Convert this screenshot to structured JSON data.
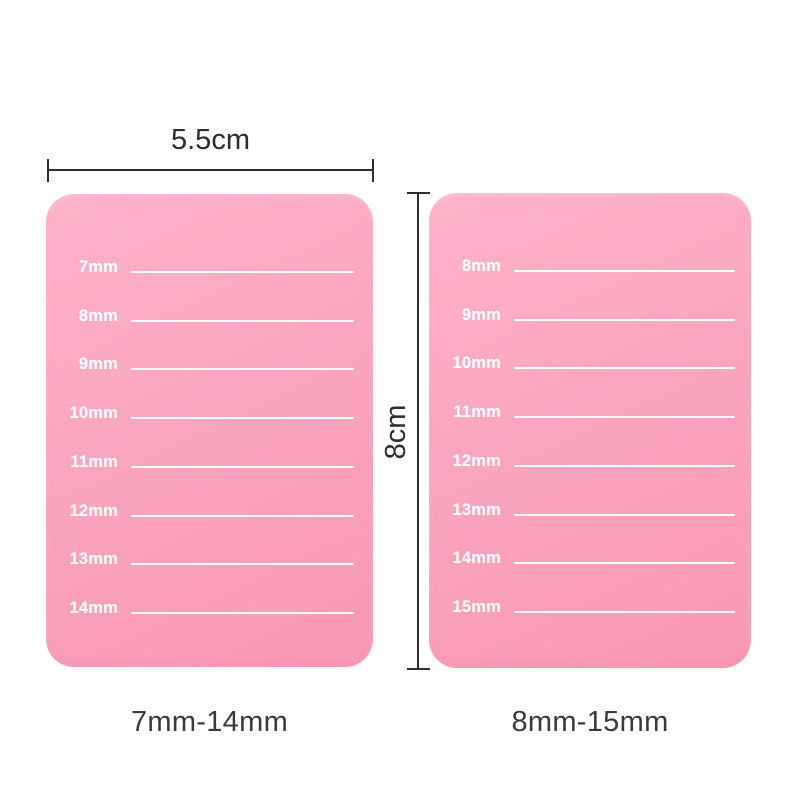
{
  "rulers": {
    "width_label": "5.5cm",
    "height_label": "8cm"
  },
  "boards": [
    {
      "side": "left",
      "sizes": [
        "7mm",
        "8mm",
        "9mm",
        "10mm",
        "11mm",
        "12mm",
        "13mm",
        "14mm"
      ],
      "caption": "7mm-14mm"
    },
    {
      "side": "right",
      "sizes": [
        "8mm",
        "9mm",
        "10mm",
        "11mm",
        "12mm",
        "13mm",
        "14mm",
        "15mm"
      ],
      "caption": "8mm-15mm"
    }
  ],
  "colors": {
    "board_pink": "#fba5bf",
    "board_pink_light": "#fdb3c9",
    "board_pink_dark": "#f898b4",
    "line_white": "#ffffff",
    "ruler": "#2f2f2f",
    "caption_text": "#3a3a3a",
    "page_bg": "#ffffff"
  }
}
